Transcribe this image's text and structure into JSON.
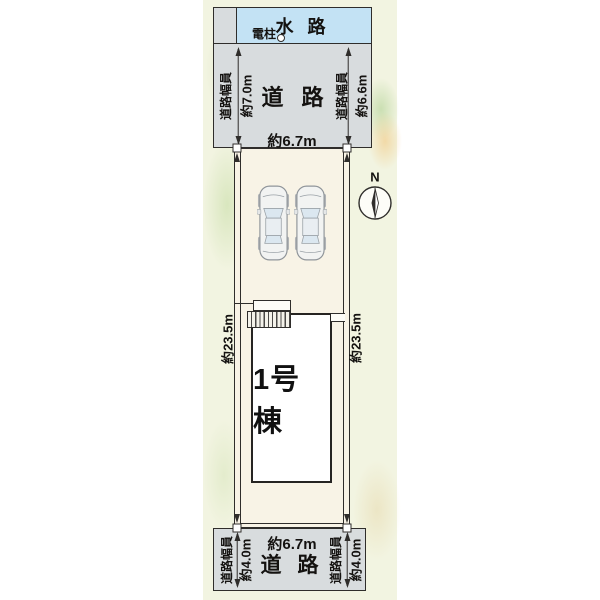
{
  "colors": {
    "page_bg": "#ffffff",
    "canvas_bg": "#f2f4e1",
    "water": "#c3e2f4",
    "road": "#d8dcde",
    "lot": "#f8f3e6",
    "building": "#ffffff",
    "line": "#2f2d2b"
  },
  "plan": {
    "waterway": {
      "label": "水路"
    },
    "utility_pole": {
      "label": "電柱"
    },
    "compass": {
      "label": "N"
    },
    "top_road": {
      "name": "道路",
      "width_caption": "道路幅員",
      "west_width": "約7.0m",
      "east_width": "約6.6m",
      "frontage": "約6.7m"
    },
    "bottom_road": {
      "name": "道路",
      "width_caption": "道路幅員",
      "west_width": "約4.0m",
      "east_width": "約4.0m",
      "frontage": "約6.7m"
    },
    "lot": {
      "west_depth": "約23.5m",
      "east_depth": "約23.5m"
    },
    "building": {
      "label": "1号棟"
    }
  }
}
